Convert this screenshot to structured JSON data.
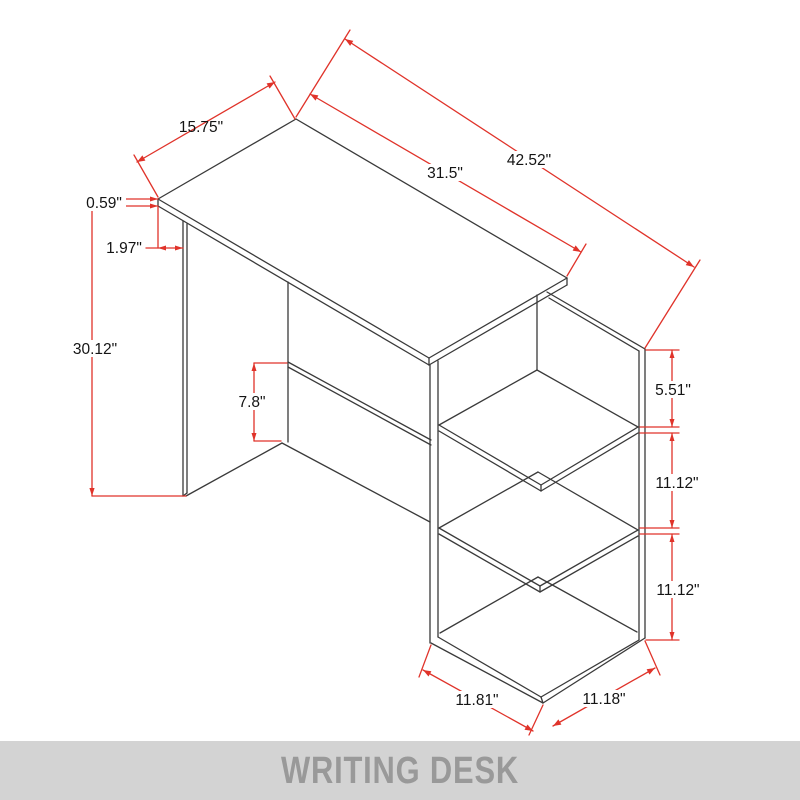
{
  "title": {
    "label": "WRITING DESK"
  },
  "colors": {
    "outline": "#3a3a3a",
    "dimension": "#e0332a",
    "banner_bg": "#d3d3d3",
    "banner_text": "#999999",
    "label_text": "#141414"
  },
  "dimensions": {
    "top_depth": "15.75\"",
    "desktop_width": "31.5\"",
    "total_width": "42.52\"",
    "top_thickness": "0.59\"",
    "overhang": "1.97\"",
    "height": "30.12\"",
    "back_panel_height": "7.8\"",
    "shelf_gap_top": "5.51\"",
    "shelf_gap_middle": "11.12\"",
    "shelf_gap_bottom": "11.12\"",
    "base_width": "11.81\"",
    "base_depth": "11.18\""
  }
}
